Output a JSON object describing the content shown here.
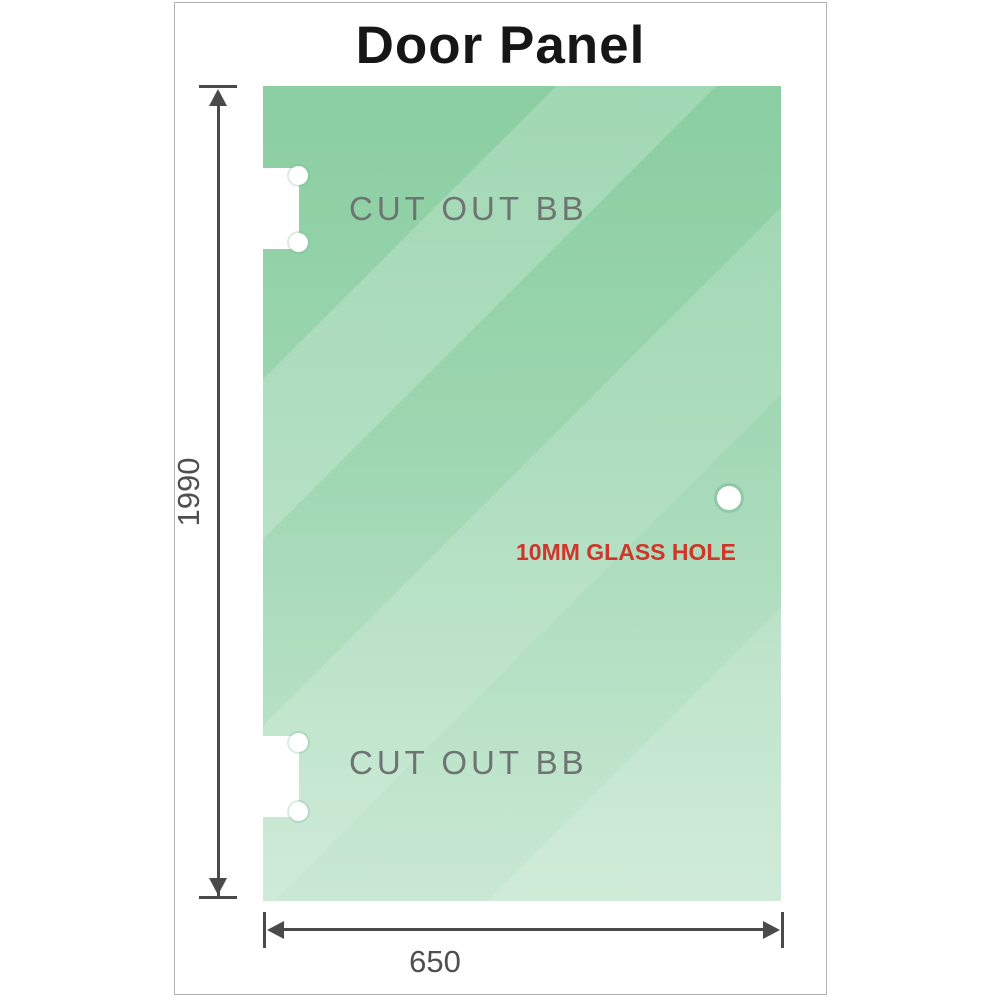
{
  "title": "Door Panel",
  "panel": {
    "cutout_top_label": "CUT OUT BB",
    "cutout_bottom_label": "CUT OUT BB",
    "glass_hole_label": "10MM GLASS HOLE"
  },
  "dimensions": {
    "height_value": "1990",
    "width_value": "650"
  },
  "colors": {
    "glass_green_top": "#8acea1",
    "glass_green_bottom": "#c6e7d1",
    "annotation_red": "#cf352b",
    "cutout_label_gray": "#6e7472",
    "dimension_gray": "#4a4a4a",
    "title_black": "#161616",
    "frame_border_gray": "#b4b4b4"
  }
}
